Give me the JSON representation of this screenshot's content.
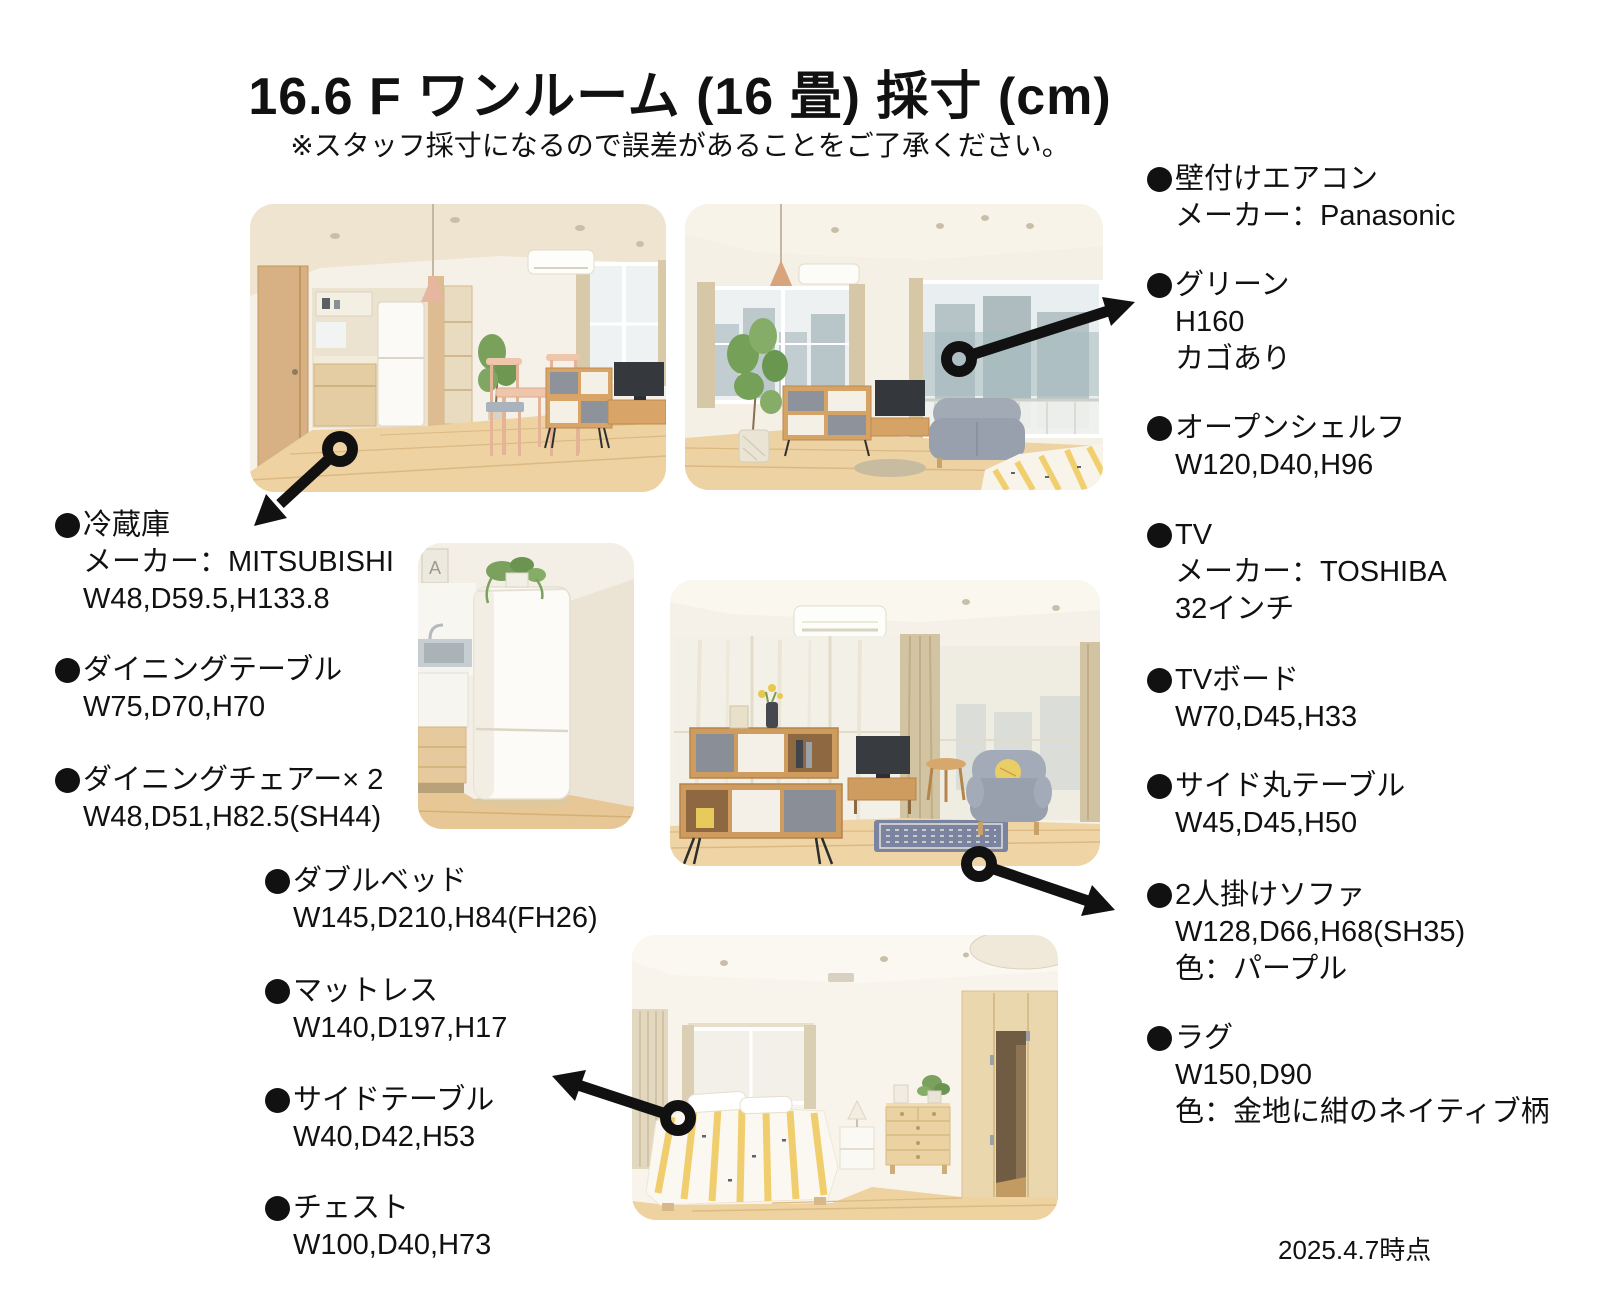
{
  "page": {
    "title": "16.6 F ワンルーム (16 畳) 採寸 (cm)",
    "subtitle": "※スタッフ採寸になるので誤差があることをご了承ください。",
    "date_note": "2025.4.7時点"
  },
  "colors": {
    "text": "#111111",
    "background": "#ffffff",
    "callout": "#111111"
  },
  "photo_text": {
    "fridge_frame_letter": "A"
  },
  "annotations": {
    "left_top": [
      {
        "name": "冷蔵庫",
        "lines": [
          "メーカー：MITSUBISHI",
          "W48,D59.5,H133.8"
        ]
      },
      {
        "name": "ダイニングテーブル",
        "lines": [
          "W75,D70,H70"
        ]
      },
      {
        "name": "ダイニングチェアー× 2",
        "lines": [
          "W48,D51,H82.5(SH44)"
        ]
      }
    ],
    "left_bottom": [
      {
        "name": "ダブルベッド",
        "lines": [
          "W145,D210,H84(FH26)"
        ]
      },
      {
        "name": "マットレス",
        "lines": [
          "W140,D197,H17"
        ]
      },
      {
        "name": "サイドテーブル",
        "lines": [
          "W40,D42,H53"
        ]
      },
      {
        "name": "チェスト",
        "lines": [
          "W100,D40,H73"
        ]
      }
    ],
    "right": [
      {
        "name": "壁付けエアコン",
        "lines": [
          "メーカー：Panasonic"
        ]
      },
      {
        "name": "グリーン",
        "lines": [
          "H160",
          "カゴあり"
        ]
      },
      {
        "name": "オープンシェルフ",
        "lines": [
          "W120,D40,H96"
        ]
      },
      {
        "name": "TV",
        "lines": [
          "メーカー：TOSHIBA",
          "32インチ"
        ]
      },
      {
        "name": "TVボード",
        "lines": [
          "W70,D45,H33"
        ]
      },
      {
        "name": "サイド丸テーブル",
        "lines": [
          "W45,D45,H50"
        ]
      },
      {
        "name": "2人掛けソファ",
        "lines": [
          "W128,D66,H68(SH35)",
          "色：パープル"
        ]
      },
      {
        "name": "ラグ",
        "lines": [
          "W150,D90",
          "色：金地に紺のネイティブ柄"
        ]
      }
    ]
  }
}
